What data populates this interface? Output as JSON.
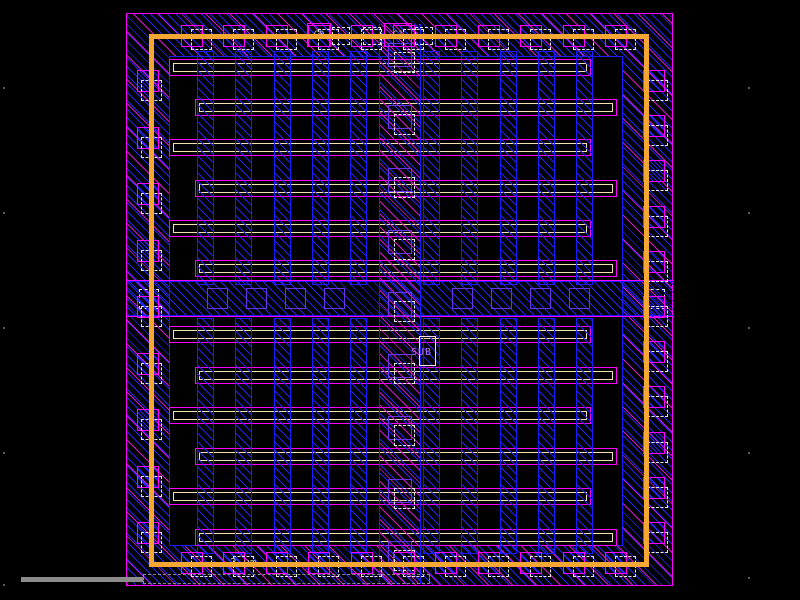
{
  "labels": {
    "c0": "C0",
    "c1": "C1",
    "sub": "SUB"
  },
  "scale": {
    "text": "2 µm"
  },
  "colors": {
    "background": "#000000",
    "boundary": "#FF00FF",
    "hatch_blue": "#2424F0",
    "hatch_magenta": "#D512D5",
    "blue_border": "#1A1AFF",
    "contact_purple": "#6A35E8",
    "contact_dashed": "#E4E4E4",
    "finger_cream": "#F2E2B2",
    "ring_orange": "#F5A733",
    "label_text": "#BDBDBD",
    "sub_text": "#B673FF",
    "sub_box": "#F5DDEB",
    "scalebar_gray": "#8C8C8C",
    "grid_dot": "#5A5A5A"
  }
}
